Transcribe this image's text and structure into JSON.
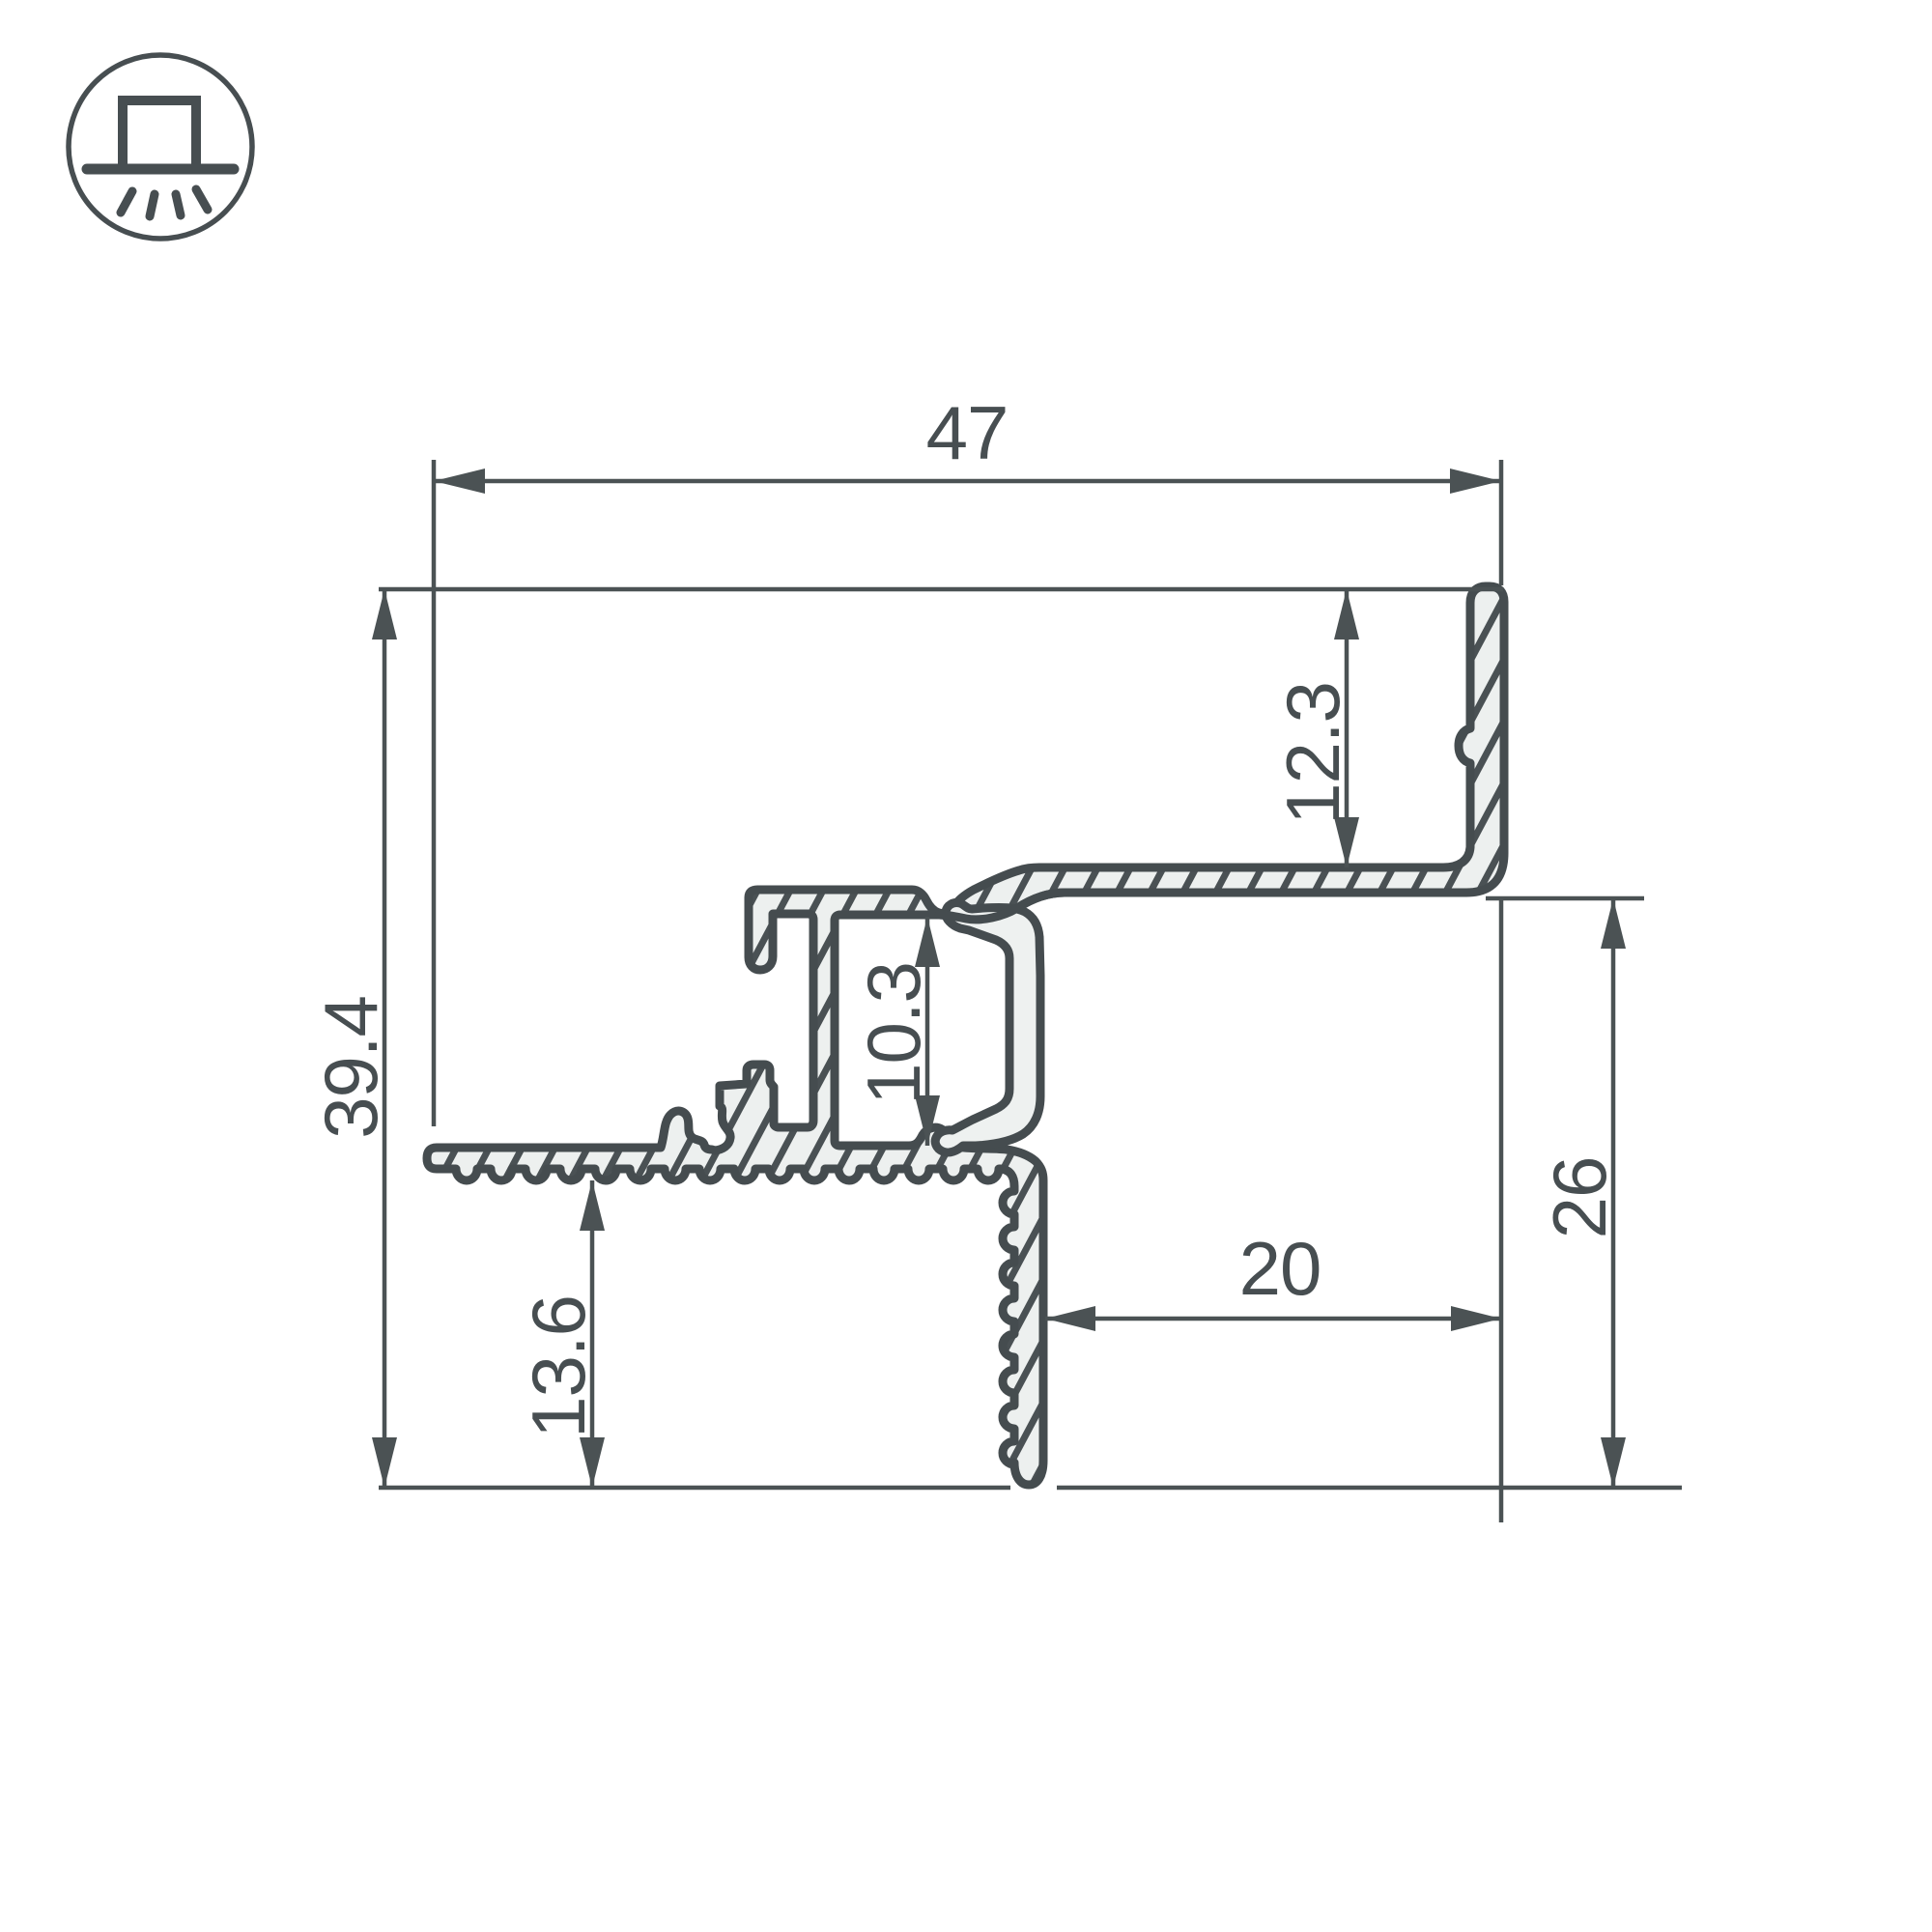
{
  "icon": {
    "name": "recessed-mount-light-icon"
  },
  "drawing": {
    "type": "technical-cross-section",
    "subject": "LED aluminium profile cross-section with dimensions",
    "labels": {
      "total_width": "47",
      "total_height": "39.4",
      "top_flange_height": "12.3",
      "channel_opening_height": "10.3",
      "right_side_height": "26",
      "step_depth": "20",
      "bottom_leg_height": "13.6"
    },
    "colors": {
      "line": "#474e51",
      "dim_line": "#4b5254",
      "aluminium_fill": "#edf0ef",
      "cover_fill": "#eef1f0",
      "background": "#ffffff"
    }
  }
}
